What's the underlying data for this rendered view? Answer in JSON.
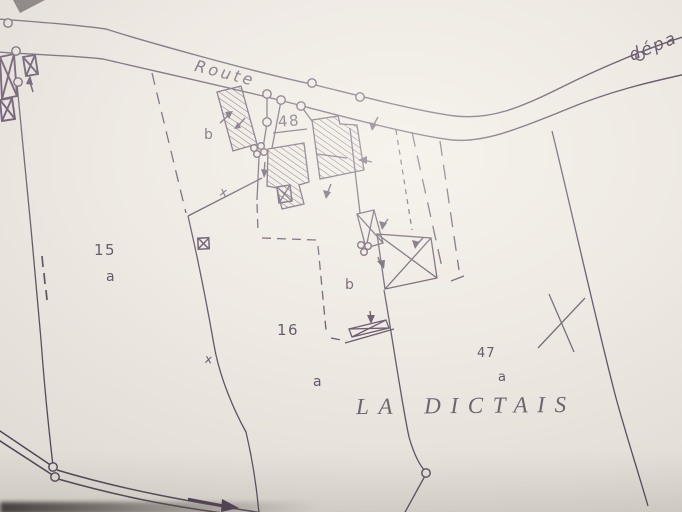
{
  "map": {
    "type": "cadastral-map-photo",
    "road": {
      "name_label": "Route",
      "name_label_right": "dépa"
    },
    "parcels": [
      {
        "number": "15",
        "sub": "a"
      },
      {
        "number": "16",
        "sub": "a"
      },
      {
        "number": "47",
        "sub": "a"
      },
      {
        "number": "48",
        "sub": ""
      }
    ],
    "subdivision_labels": {
      "west": "b",
      "east": "b"
    },
    "place_name": {
      "word1": "LA",
      "word2": "DICTAIS"
    },
    "boundary_marks": {
      "x_north": "x",
      "x_south": "x"
    },
    "colors": {
      "ink": "#4a3a52",
      "ink_bold": "#3e2c4d",
      "serif_ink": "#56505c",
      "paper": "#ebe7e0",
      "paper_highlight": "#f2ede7",
      "paper_shade": "#e3e0d8"
    }
  }
}
